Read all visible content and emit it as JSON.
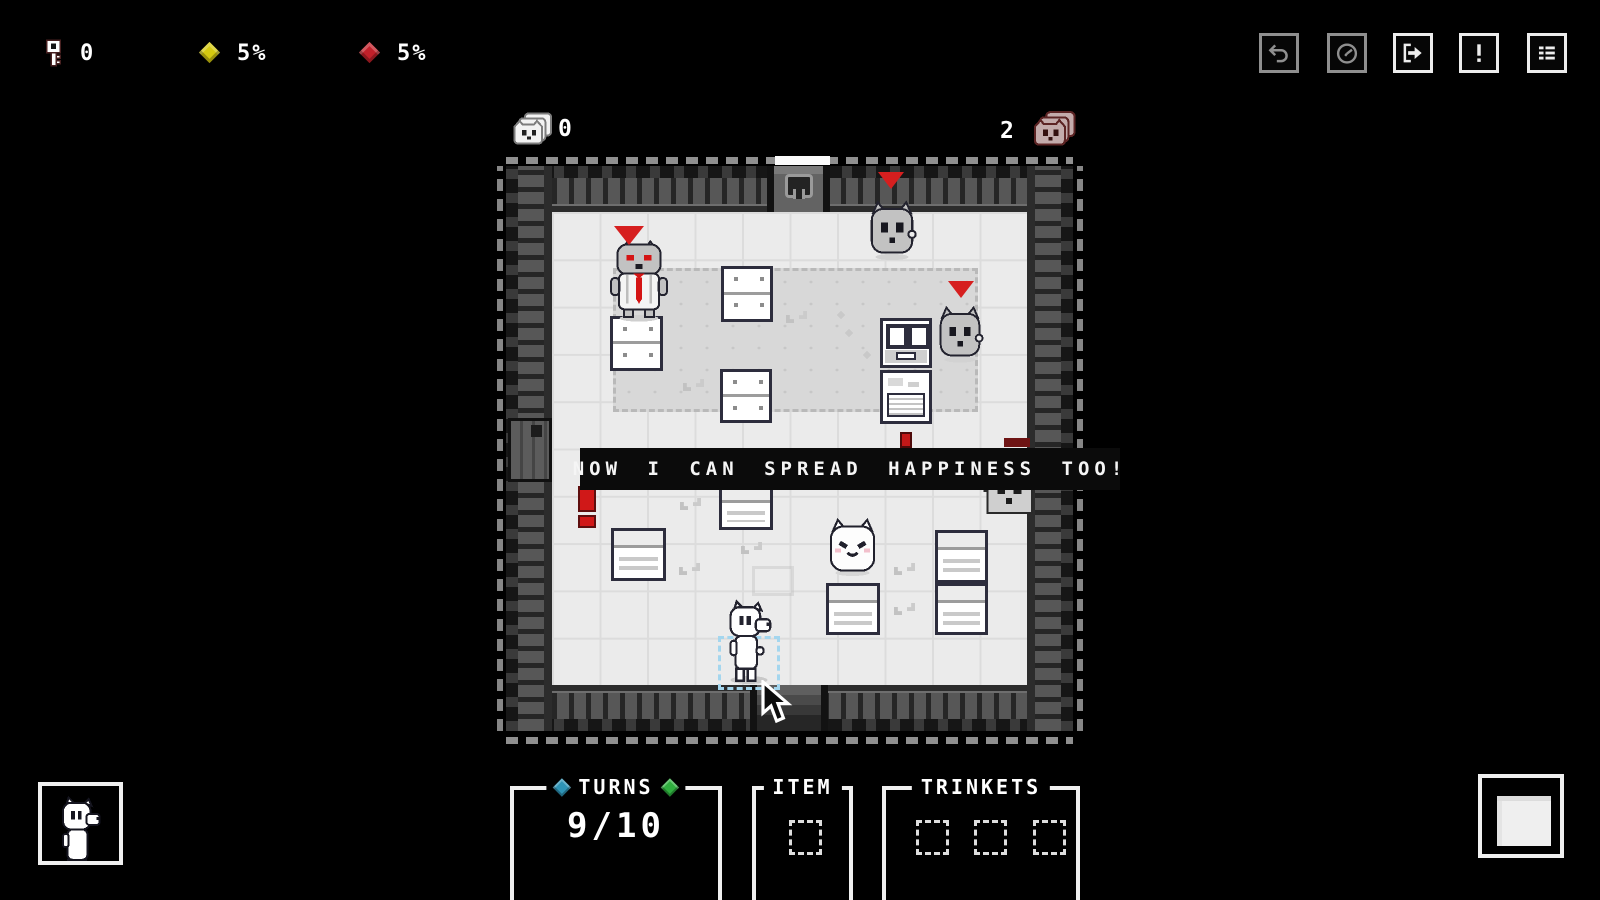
{
  "hud": {
    "keys": {
      "icon": "key-icon",
      "value": "0"
    },
    "yellow_stat": {
      "icon": "diamond-yellow-icon",
      "value": "5%",
      "color": "#d6ca10"
    },
    "red_stat": {
      "icon": "diamond-red-icon",
      "value": "5%",
      "color": "#c2202a"
    }
  },
  "toolbar": {
    "buttons": [
      {
        "icon": "undo-icon",
        "enabled": false
      },
      {
        "icon": "clock-icon",
        "enabled": false
      },
      {
        "icon": "exit-arrow-icon",
        "enabled": true
      },
      {
        "icon": "exclamation-icon",
        "enabled": true
      },
      {
        "icon": "list-icon",
        "enabled": true
      }
    ]
  },
  "cat_counters": {
    "left": {
      "icon": "cat-stack-icon",
      "value": "0"
    },
    "right": {
      "icon": "cat-stack-red-icon",
      "value": "2"
    }
  },
  "dialog": {
    "text": "NOW I CAN SPREAD HAPPINESS TOO!"
  },
  "panels": {
    "turns": {
      "label": "TURNS",
      "value": "9/10",
      "left_diamond_color": "#2e93b5",
      "right_diamond_color": "#2fae3e"
    },
    "item": {
      "label": "ITEM",
      "slots": 1
    },
    "trinkets": {
      "label": "TRINKETS",
      "slots": 3
    }
  },
  "room": {
    "doors": [
      "top-locked-door",
      "bottom-open-door",
      "left-door"
    ],
    "entities": [
      {
        "name": "boss-cat",
        "note": "gray cat with red eyes and red tie, red triangle marker"
      },
      {
        "name": "enemy-cat-top",
        "note": "red triangle marker"
      },
      {
        "name": "enemy-cat-right",
        "note": "red triangle marker, beside chest"
      },
      {
        "name": "happy-cat"
      },
      {
        "name": "peeking-cat"
      },
      {
        "name": "player-dog",
        "selected": true
      },
      {
        "name": "chest"
      },
      {
        "name": "desk"
      },
      {
        "name": "dresser"
      },
      {
        "name": "dresser"
      },
      {
        "name": "dresser"
      },
      {
        "name": "bed"
      },
      {
        "name": "bed"
      },
      {
        "name": "bed"
      },
      {
        "name": "bed"
      },
      {
        "name": "bed"
      },
      {
        "name": "red-exclamation-marker"
      }
    ]
  },
  "colors": {
    "background": "#000000",
    "floor": "#ebebeb",
    "carpet": "#d8d8d8",
    "accent_red": "#d61f1f",
    "selection_blue": "#a4d6ee",
    "panel_border": "#f0f0f0"
  }
}
